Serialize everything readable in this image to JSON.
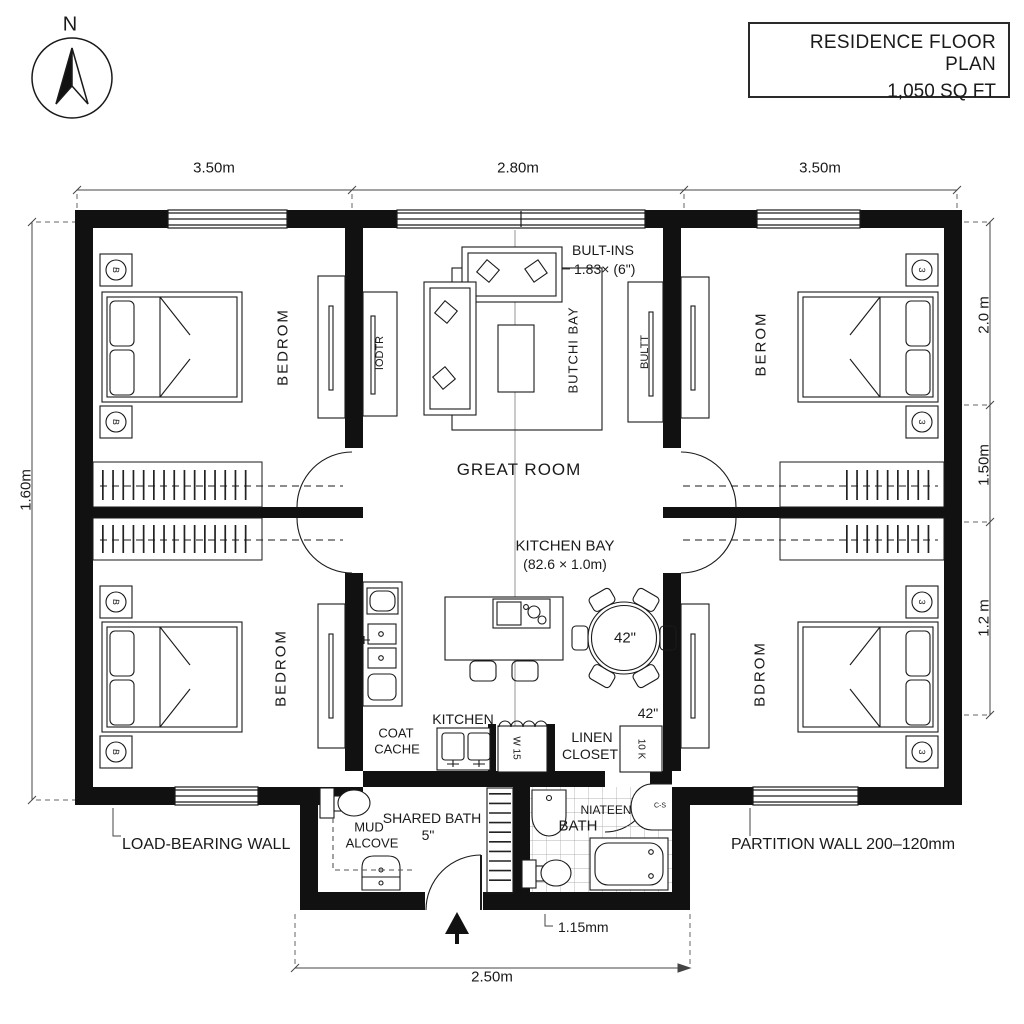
{
  "compass": {
    "label": "N"
  },
  "title_block": {
    "line1": "RESIDENCE FLOOR PLAN",
    "line2": "1,050 SQ FT"
  },
  "dimensions": {
    "top": [
      "3.50m",
      "2.80m",
      "3.50m"
    ],
    "left": "1.60m",
    "right": [
      "2.0 m",
      "1.50m",
      "1.2 m"
    ],
    "bottom_width": "2.50m",
    "entry_offset": "1.15mm"
  },
  "wall_legend": {
    "load_bearing": "LOAD-BEARING WALL",
    "partition": "PARTITION WALL 200–120mm"
  },
  "rooms": {
    "bedroom_top_left": "BEDROM",
    "bedroom_top_right": "BEROM",
    "bedroom_bottom_left": "BEDROM",
    "bedroom_bottom_right": "BDROM",
    "great_room": "GREAT ROOM",
    "kitchen_bay": "KITCHEN BAY",
    "kitchen_bay_size": "(82.6 × 1.0m)",
    "kitchen": "KITCHEN",
    "coat_cache_line1": "COAT",
    "coat_cache_line2": "CACHE",
    "linen_closet_line1": "LINEN",
    "linen_closet_line2": "CLOSET",
    "shared_bath": "SHARED BATH",
    "shared_bath_size": "5\"",
    "mud_alcove_line1": "MUD",
    "mud_alcove_line2": "ALCOVE",
    "main_bath_prefix": "NIATEEN",
    "main_bath": "BATH"
  },
  "annotations": {
    "built_ins": "BULT-INS",
    "built_ins_size": "1.83× (6\")",
    "butchi_bay": "BUTCHI BAY",
    "built_cabinet_right": "BULTT",
    "built_cabinet_left": "IODTR",
    "dining_table_size": "42\"",
    "hall_closet_size": "42\"",
    "cabinet_label_w": "W 15",
    "cabinet_label_k": "10 K",
    "bath_sink_tag": "C-S",
    "nightstand_symbol_left": "B",
    "nightstand_symbol_right": "3"
  },
  "colors": {
    "line": "#1a1a1a",
    "wall": "#111111",
    "tile": "#9a9a9a"
  }
}
